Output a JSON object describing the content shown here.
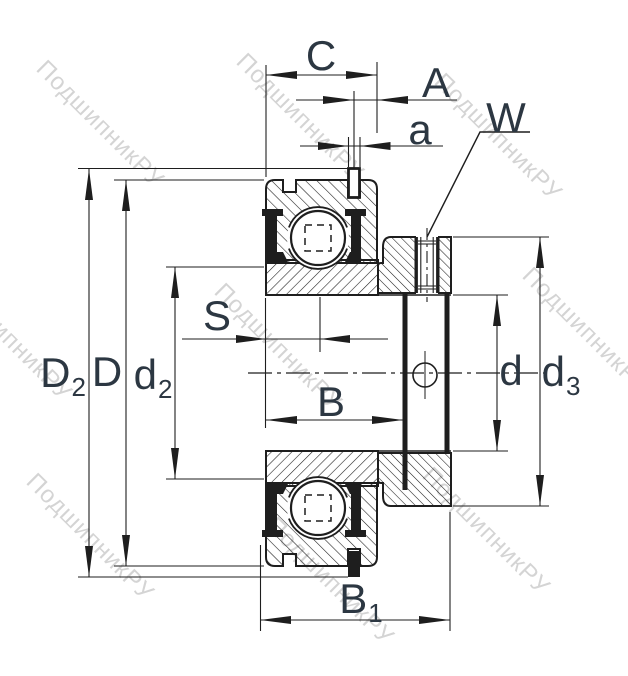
{
  "labels": {
    "C": {
      "main": "C"
    },
    "A": {
      "main": "A"
    },
    "a": {
      "main": "a"
    },
    "W": {
      "main": "W"
    },
    "S": {
      "main": "S"
    },
    "B": {
      "main": "B"
    },
    "B1": {
      "main": "B",
      "sub": "1"
    },
    "D2": {
      "main": "D",
      "sub": "2"
    },
    "D": {
      "main": "D"
    },
    "d2": {
      "main": "d",
      "sub": "2"
    },
    "d": {
      "main": "d"
    },
    "d3": {
      "main": "d",
      "sub": "3"
    }
  },
  "watermark": {
    "text": "ПодшипникРУ"
  },
  "colors": {
    "line": "#1e1e1e",
    "label": "#2c3742",
    "watermark": "rgba(125,125,125,0.33)",
    "background": "#ffffff"
  }
}
